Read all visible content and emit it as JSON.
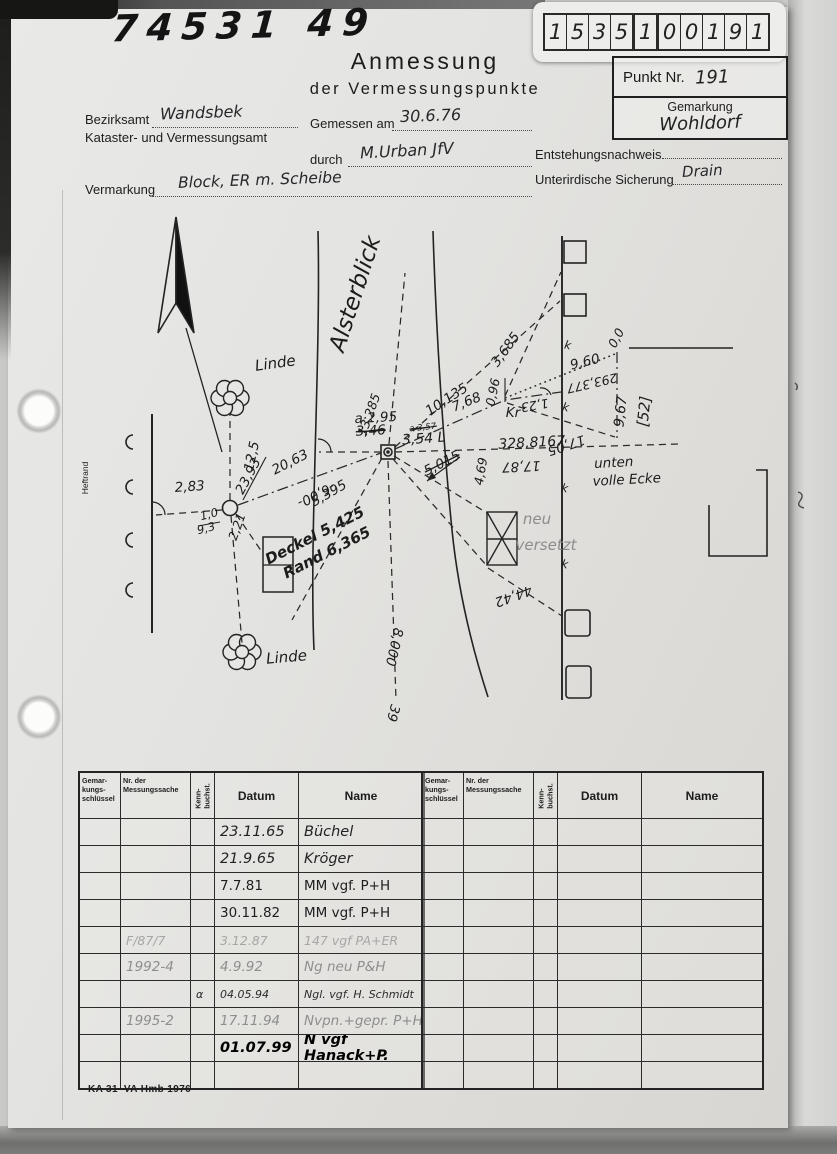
{
  "scan": {
    "top_left_number": "74531 49",
    "footer_code": "KA 31–VA Hmb 1976"
  },
  "slip": {
    "digits": [
      "1",
      "5",
      "3",
      "5",
      "1",
      "0",
      "0",
      "1",
      "9",
      "1"
    ]
  },
  "header": {
    "title_line1": "Anmessung",
    "title_line2": "der Vermessungspunkte",
    "punkt_nr_label": "Punkt Nr.",
    "punkt_nr_value": "191",
    "gemarkung_label": "Gemarkung",
    "gemarkung_value": "Wohldorf"
  },
  "form": {
    "bezirksamt_label": "Bezirksamt",
    "bezirksamt_value": "Wandsbek",
    "amt_line2": "Kataster- und Vermessungsamt",
    "gemessen_label": "Gemessen am",
    "gemessen_value": "30.6.76",
    "durch_label": "durch",
    "durch_value": "M.Urban  JfV",
    "entstehung_label": "Entstehungsnachweis",
    "sicherung_label": "Unterirdische Sicherung",
    "sicherung_value": "Drain",
    "vermarkung_label": "Vermarkung",
    "vermarkung_value": "Block,  ER m. Scheibe"
  },
  "sketch": {
    "annotations": [
      {
        "t": "Alsterblick",
        "x": 362,
        "y": 296,
        "r": -72,
        "c": "sz23"
      },
      {
        "t": "Linde",
        "x": 276,
        "y": 368,
        "r": -8,
        "c": "sz15"
      },
      {
        "t": "Linde",
        "x": 287,
        "y": 662,
        "r": -5,
        "c": "sz15"
      },
      {
        "t": "Heftrand",
        "x": 88,
        "y": 478,
        "r": -90,
        "c": "sz8 print"
      },
      {
        "t": "12,5",
        "x": 256,
        "y": 457,
        "r": -78,
        "c": "sz13"
      },
      {
        "t": "2,83",
        "x": 190,
        "y": 491,
        "r": -4,
        "c": "sz13"
      },
      {
        "t": "1,0",
        "x": 210,
        "y": 518,
        "r": -14,
        "c": "sz11"
      },
      {
        "t": "9,3",
        "x": 207,
        "y": 532,
        "r": -14,
        "c": "sz11"
      },
      {
        "t": "2,21",
        "x": 241,
        "y": 528,
        "r": -70,
        "c": "sz12"
      },
      {
        "t": "23,93",
        "x": 252,
        "y": 478,
        "r": -62,
        "c": "sz13"
      },
      {
        "t": "20,63",
        "x": 292,
        "y": 466,
        "r": -27,
        "c": "sz13"
      },
      {
        "t": "-6,00-",
        "x": 314,
        "y": 491,
        "r": 153,
        "c": "sz13"
      },
      {
        "t": "5,395",
        "x": 331,
        "y": 497,
        "r": -30,
        "c": "sz13"
      },
      {
        "t": "Deckel 5,425",
        "x": 317,
        "y": 540,
        "r": -27,
        "c": "sz15 bold"
      },
      {
        "t": "Rand 6,365",
        "x": 329,
        "y": 557,
        "r": -27,
        "c": "sz15 bold"
      },
      {
        "t": "a·2,95",
        "x": 376,
        "y": 422,
        "r": -3,
        "c": "sz13"
      },
      {
        "t": "3,46",
        "x": 371,
        "y": 435,
        "r": -3,
        "c": "sz13 strike"
      },
      {
        "t": "13,285",
        "x": 373,
        "y": 416,
        "r": -70,
        "c": "sz12"
      },
      {
        "t": "a·3,57",
        "x": 423,
        "y": 430,
        "r": -6,
        "c": "sz8 strike"
      },
      {
        "t": "3,54 L",
        "x": 424,
        "y": 443,
        "r": -4,
        "c": "sz14"
      },
      {
        "t": "5,015",
        "x": 444,
        "y": 467,
        "r": -27,
        "c": "sz13 strike"
      },
      {
        "t": "10,135",
        "x": 449,
        "y": 403,
        "r": -33,
        "c": "sz13"
      },
      {
        "t": "7,68",
        "x": 468,
        "y": 406,
        "r": -22,
        "c": "sz13"
      },
      {
        "t": "0,96",
        "x": 497,
        "y": 393,
        "r": -78,
        "c": "sz12"
      },
      {
        "t": "Kr",
        "x": 513,
        "y": 417,
        "r": 0,
        "c": "sz13"
      },
      {
        "t": "1,23",
        "x": 534,
        "y": 401,
        "r": 170,
        "c": "sz12"
      },
      {
        "t": "3,685",
        "x": 509,
        "y": 352,
        "r": -54,
        "c": "sz13"
      },
      {
        "t": "9,60",
        "x": 586,
        "y": 366,
        "r": -14,
        "c": "sz13"
      },
      {
        "t": "293,377",
        "x": 591,
        "y": 379,
        "r": 167,
        "c": "sz12"
      },
      {
        "t": "0,0",
        "x": 620,
        "y": 340,
        "r": -62,
        "c": "sz12"
      },
      {
        "t": "9,67",
        "x": 625,
        "y": 412,
        "r": -84,
        "c": "sz14"
      },
      {
        "t": "[52]",
        "x": 649,
        "y": 412,
        "r": -84,
        "c": "sz15"
      },
      {
        "t": "17,05",
        "x": 565,
        "y": 441,
        "r": 162,
        "c": "sz13"
      },
      {
        "t": "328,8167",
        "x": 532,
        "y": 447,
        "r": -3,
        "c": "sz14"
      },
      {
        "t": "17,87",
        "x": 521,
        "y": 462,
        "r": 177,
        "c": "sz13"
      },
      {
        "t": "4,69",
        "x": 485,
        "y": 472,
        "r": -80,
        "c": "sz12"
      },
      {
        "t": "neu",
        "x": 537,
        "y": 524,
        "r": 0,
        "c": "sz15 pen"
      },
      {
        "t": "versetzt",
        "x": 546,
        "y": 550,
        "r": 0,
        "c": "sz15 pen"
      },
      {
        "t": "44,42",
        "x": 512,
        "y": 592,
        "r": 160,
        "c": "sz13"
      },
      {
        "t": "unten",
        "x": 614,
        "y": 467,
        "r": -3,
        "c": "sz13"
      },
      {
        "t": "volle Ecke",
        "x": 627,
        "y": 484,
        "r": -3,
        "c": "sz13"
      },
      {
        "t": "8,000",
        "x": 390,
        "y": 646,
        "r": 103,
        "c": "sz13"
      },
      {
        "t": "39",
        "x": 389,
        "y": 712,
        "r": 105,
        "c": "sz13"
      },
      {
        "t": "k",
        "x": 567,
        "y": 349,
        "r": 10,
        "c": "sz11"
      },
      {
        "t": "k",
        "x": 565,
        "y": 411,
        "r": 10,
        "c": "sz11"
      },
      {
        "t": "k",
        "x": 564,
        "y": 492,
        "r": 10,
        "c": "sz11"
      },
      {
        "t": "k",
        "x": 564,
        "y": 568,
        "r": 10,
        "c": "sz11"
      }
    ]
  },
  "table": {
    "headers": [
      "Gemar-\nkungs-\nschlüssel",
      "Nr. der\nMessungssache",
      "Kenn-\nbuchst.",
      "Datum",
      "Name"
    ],
    "row_count": 10,
    "rows": [
      {
        "g": "",
        "s": "",
        "k": "",
        "d": "23.11.65",
        "n": "Büchel",
        "cls": "hw"
      },
      {
        "g": "",
        "s": "",
        "k": "",
        "d": "21.9.65",
        "n": "Kröger",
        "cls": "hw"
      },
      {
        "g": "",
        "s": "",
        "k": "",
        "d": "7.7.81",
        "n": "MM vgf. P+H",
        "cls": "hw2"
      },
      {
        "g": "",
        "s": "",
        "k": "",
        "d": "30.11.82",
        "n": "MM vgf. P+H",
        "cls": "hw2"
      },
      {
        "g": "",
        "s": "F/87/7",
        "k": "",
        "d": "3.12.87",
        "n": "147 vgf PA+ER",
        "cls": "pencil-faint"
      },
      {
        "g": "",
        "s": "1992-4",
        "k": "",
        "d": "4.9.92",
        "n": "Ng neu  P&H",
        "cls": "pencil-row"
      },
      {
        "g": "",
        "s": "",
        "k": "α",
        "d": "04.05.94",
        "n": "Ngl. vgf. H. Schmidt",
        "cls": "hw3"
      },
      {
        "g": "",
        "s": "1995-2",
        "k": "",
        "d": "17.11.94",
        "n": "Nvpn.+gepr. P+H",
        "cls": "pencil-row"
      },
      {
        "g": "",
        "s": "",
        "k": "",
        "d": "01.07.99",
        "n": "N vgf  Hanack+P.",
        "cls": "marker-row"
      },
      {
        "g": "",
        "s": "",
        "k": "",
        "d": "",
        "n": "",
        "cls": ""
      }
    ]
  }
}
